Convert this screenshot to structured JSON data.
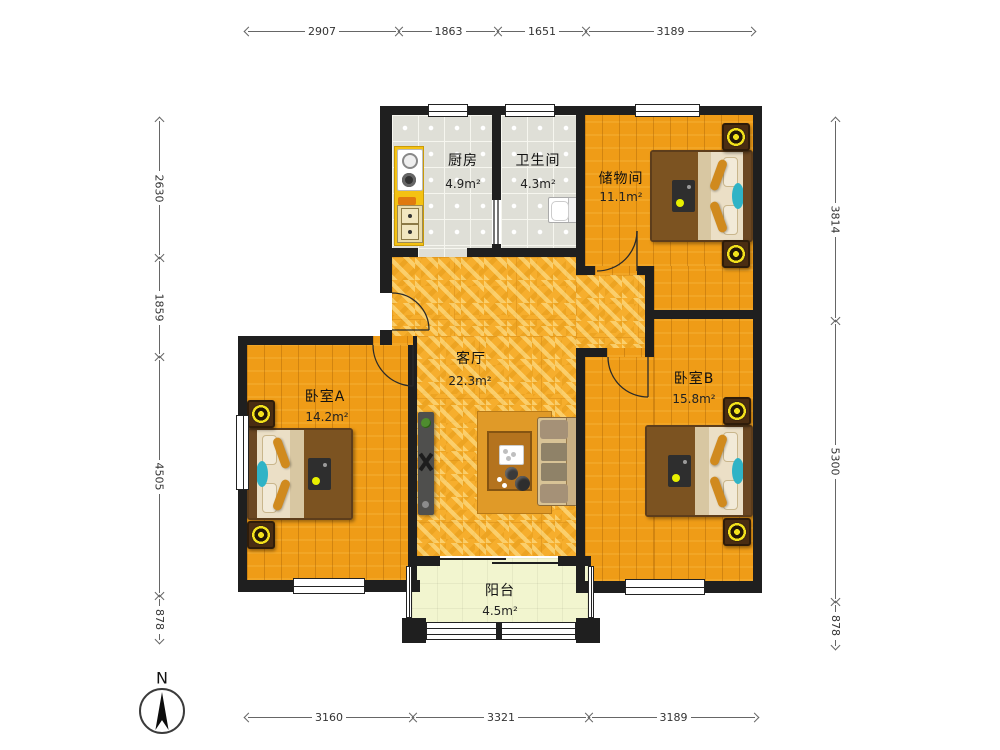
{
  "compass": {
    "label": "N"
  },
  "dimensions": {
    "top": [
      "2907",
      "1863",
      "1651",
      "3189"
    ],
    "bottom": [
      "3160",
      "3321",
      "3189"
    ],
    "left": [
      "2630",
      "1859",
      "4505",
      "878"
    ],
    "right": [
      "3814",
      "5300",
      "878"
    ]
  },
  "rooms": {
    "kitchen": {
      "name": "厨房",
      "area": "4.9m²"
    },
    "bathroom": {
      "name": "卫生间",
      "area": "4.3m²"
    },
    "storage": {
      "name": "储物间",
      "area": "11.1m²"
    },
    "living": {
      "name": "客厅",
      "area": "22.3m²"
    },
    "bedroomA": {
      "name": "卧室A",
      "area": "14.2m²"
    },
    "bedroomB": {
      "name": "卧室B",
      "area": "15.8m²"
    },
    "balcony": {
      "name": "阳台",
      "area": "4.5m²"
    }
  },
  "colors": {
    "wall": "#1f1f1f",
    "wood_floor": "#EF9C17",
    "gold_floor": "#F6AE2D",
    "tile_floor": "#DFDFD7",
    "balcony_floor": "#F2F5CF",
    "counter_yellow": "#F4C213",
    "lamp_yellow": "#F2E11C",
    "teal_accent": "#2FB3C6",
    "blanket_brown": "#7C5321",
    "mattress_beige": "#EBDFC6"
  }
}
